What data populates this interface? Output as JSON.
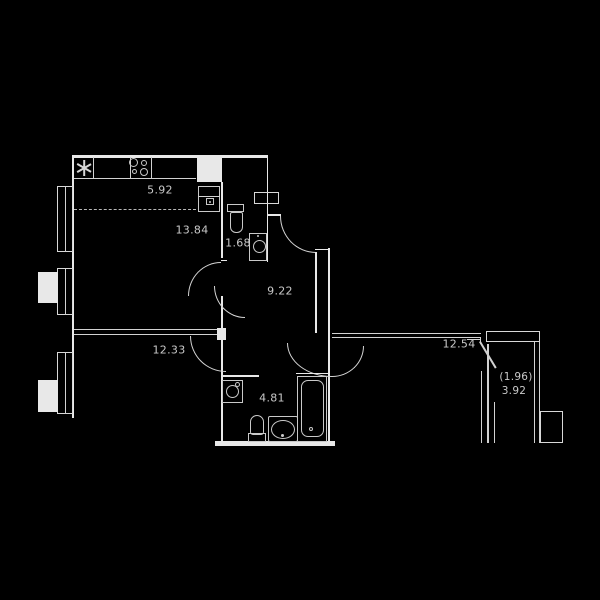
{
  "floorplan": {
    "type": "apartment-floor-plan",
    "background_color": "#000000",
    "wall_color": "#e8e8e8",
    "fixture_color": "#c9c9c9",
    "label_color": "#c9c9c9",
    "labels": {
      "kitchen_zone_area": "5.92",
      "living_zone_area": "13.84",
      "wc_area": "1.68",
      "center_room_area": "9.22",
      "hall_area": "12.33",
      "bedroom_area": "12.54",
      "bathroom_area": "4.81",
      "balcony_area_reduced": "(1.96)",
      "balcony_area": "3.92"
    },
    "fixtures": [
      "fridge",
      "stove",
      "kitchen-sink",
      "toilet",
      "washing-machine",
      "bathtub",
      "vanity-sink",
      "vent-shaft",
      "window",
      "ac-unit"
    ]
  }
}
